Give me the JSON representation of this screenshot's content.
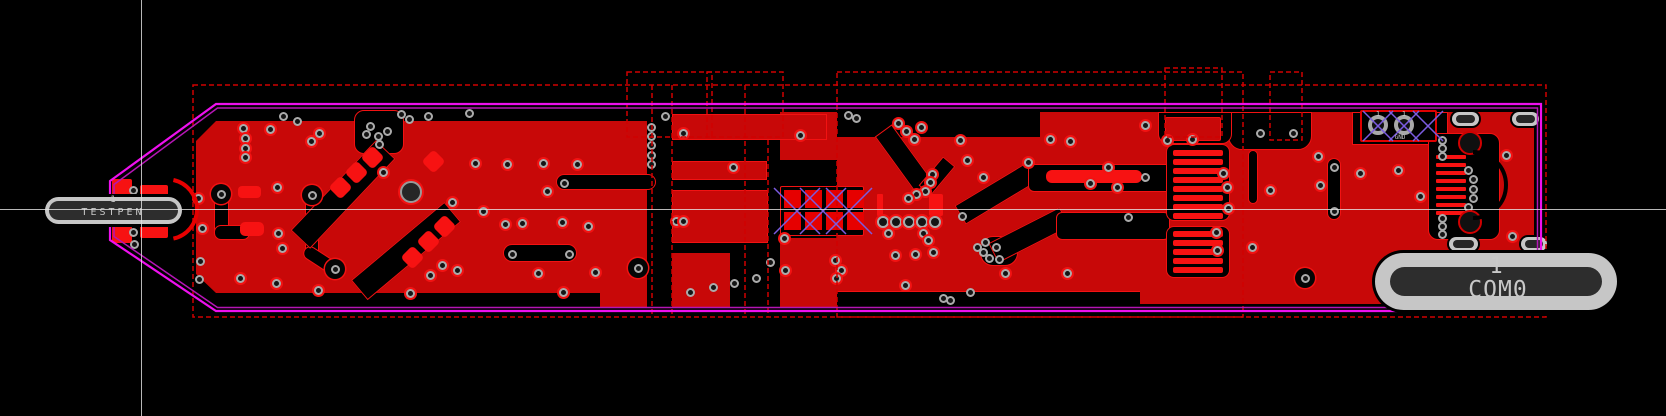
{
  "app": {
    "view": "pcb-copper-layer-viewer"
  },
  "labels": {
    "left_pad_number": "1",
    "left_pad_name": "TESTPEN",
    "right_pad_number": "1",
    "right_pad_name": "COM0",
    "th_pad1_label": "1",
    "th_pad2_label": "1",
    "th_pad2_sub": "GND"
  },
  "colors": {
    "background": "#000000",
    "copper_pour": "#C80808",
    "pad_bright": "#F71212",
    "clearance_edge": "#F21212",
    "hatch_pad": "#E60000",
    "courtyard_dash": "#CF0000",
    "outline_main": "#EE10EE",
    "outline_inner": "#B515B5",
    "hatch_x": "#7B5BE0",
    "via_ring": "#ABABAB",
    "via_hole": "#141414",
    "pill_body": "#C6C6C6",
    "pill_slot": "#2D2D2D",
    "crosshair": "#E5E5E5",
    "arc_red": "#E80000"
  },
  "crosshair": {
    "x": 141.5,
    "y": 209.5
  },
  "board": {
    "outline_outer": "110,181 216,104 1541,104 1541,311 216,311 110,240",
    "outline_inner": "114,184.5 217.5,108 1537.5,108 1537.5,307.5 217.5,307.5 114,236.5"
  },
  "pills": {
    "left": {
      "x": 45,
      "y": 197,
      "w": 137,
      "h": 27,
      "inset": 4,
      "num": {
        "x": 113,
        "y": 195,
        "fs": 9
      },
      "name": {
        "x": 113,
        "y": 207,
        "fs": 10,
        "ls": 3
      }
    },
    "right": {
      "x": 1375,
      "y": 253,
      "w": 242,
      "h": 57,
      "inset_x": 15,
      "inset_y": 14,
      "num": {
        "x": 1496,
        "y": 254,
        "fs": 22
      },
      "name": {
        "x": 1498,
        "y": 277,
        "fs": 23,
        "ls": 1
      }
    }
  },
  "gray_pills": [
    [
      1452,
      112,
      27,
      14
    ],
    [
      1512,
      112,
      27,
      14
    ],
    [
      1449,
      237,
      29,
      14
    ],
    [
      1521,
      237,
      26,
      14
    ]
  ],
  "zones": [
    {
      "x": 196,
      "y": 121,
      "w": 451,
      "h": 172,
      "clip": "polygon(0px 20px, 20px 0px, 100% 0px, 100% 100%, 20px 100%, 0px calc(100% - 19px))"
    },
    {
      "x": 837,
      "y": 137,
      "w": 203,
      "h": 156
    },
    {
      "x": 1040,
      "y": 112,
      "w": 494,
      "h": 192
    },
    {
      "x": 600,
      "y": 250,
      "w": 47,
      "h": 58
    },
    {
      "x": 672,
      "y": 253,
      "w": 58,
      "h": 55
    },
    {
      "x": 780,
      "y": 112,
      "w": 57,
      "h": 48
    },
    {
      "x": 780,
      "y": 238,
      "w": 57,
      "h": 70
    }
  ],
  "blacks": [
    {
      "x": 354,
      "y": 110,
      "w": 50,
      "h": 44,
      "r": "10px"
    },
    {
      "x": 556,
      "y": 174,
      "w": 100,
      "h": 16,
      "r": "8px"
    },
    {
      "x": 503,
      "y": 244,
      "w": 74,
      "h": 18,
      "r": "9px"
    },
    {
      "x": 214,
      "y": 189,
      "w": 15,
      "h": 47,
      "r": "7px"
    },
    {
      "x": 214,
      "y": 225,
      "w": 36,
      "h": 15,
      "r": "7px"
    },
    {
      "x": 305,
      "y": 190,
      "w": 14,
      "h": 66,
      "r": "7px"
    },
    {
      "cx": 322,
      "cy": 261,
      "w": 42,
      "h": 14,
      "rot": 33,
      "r": "7px"
    },
    {
      "cx": 343,
      "cy": 194,
      "w": 124,
      "h": 27,
      "rot": -46.5
    },
    {
      "cx": 406,
      "cy": 251,
      "w": 122,
      "h": 26,
      "rot": -40
    },
    {
      "cx": 905,
      "cy": 160,
      "w": 74,
      "h": 21,
      "rot": 54
    },
    {
      "cx": 937,
      "cy": 176,
      "w": 38,
      "h": 16,
      "rot": -50
    },
    {
      "cx": 997,
      "cy": 193,
      "w": 86,
      "h": 22,
      "rot": -31
    },
    {
      "x": 1028,
      "y": 164,
      "w": 144,
      "h": 28,
      "r": "6px"
    },
    {
      "x": 980,
      "y": 236,
      "w": 38,
      "h": 30,
      "r": "13px"
    },
    {
      "cx": 1029,
      "cy": 235,
      "w": 80,
      "h": 22,
      "rot": -27
    },
    {
      "x": 1056,
      "y": 212,
      "w": 114,
      "h": 28,
      "r": "6px"
    },
    {
      "x": 1327,
      "y": 158,
      "w": 14,
      "h": 62,
      "r": "7px"
    },
    {
      "x": 1248,
      "y": 150,
      "w": 10,
      "h": 54,
      "r": "5px"
    },
    {
      "x": 1352,
      "y": 112,
      "w": 96,
      "h": 33
    },
    {
      "x": 1228,
      "y": 112,
      "w": 84,
      "h": 38,
      "r": "0 0 14px 14px"
    },
    {
      "x": 1158,
      "y": 112,
      "w": 74,
      "h": 32,
      "r": "0 0 10px 10px"
    },
    {
      "x": 837,
      "y": 291,
      "w": 303,
      "h": 20,
      "bd": "top"
    },
    {
      "x": 1166,
      "y": 144,
      "w": 64,
      "h": 77,
      "r": "8px"
    },
    {
      "x": 1166,
      "y": 226,
      "w": 64,
      "h": 52,
      "r": "8px"
    },
    {
      "x": 1428,
      "y": 133,
      "w": 72,
      "h": 107,
      "r": "10px"
    },
    {
      "x": 780,
      "y": 186,
      "w": 84,
      "h": 50,
      "r": "2px"
    },
    {
      "x": 1360,
      "y": 110,
      "w": 77,
      "h": 32,
      "r": "2px",
      "bc": "#E00000",
      "bw": 2
    }
  ],
  "reds": [
    {
      "x": 238,
      "y": 186,
      "w": 23,
      "h": 12,
      "r": 4
    },
    {
      "x": 240,
      "y": 222,
      "w": 24,
      "h": 14,
      "r": 5
    },
    {
      "x": 112,
      "y": 179,
      "w": 20,
      "h": 17,
      "r": 2
    },
    {
      "x": 140,
      "y": 185,
      "w": 28,
      "h": 13,
      "r": 2
    },
    {
      "x": 112,
      "y": 226,
      "w": 20,
      "h": 17,
      "r": 2
    },
    {
      "x": 140,
      "y": 224,
      "w": 28,
      "h": 14,
      "r": 2
    },
    {
      "x": 877,
      "y": 194,
      "w": 6,
      "h": 22,
      "r": 1
    },
    {
      "x": 929,
      "y": 194,
      "w": 14,
      "h": 22,
      "r": 2
    },
    {
      "x": 1046,
      "y": 170,
      "w": 96,
      "h": 13,
      "r": 6
    },
    {
      "x": 1165,
      "y": 117,
      "w": 56,
      "h": 24,
      "r": 2,
      "c": "p"
    },
    {
      "x": 672,
      "y": 114,
      "w": 155,
      "h": 26,
      "c": "p"
    },
    {
      "x": 672,
      "y": 161,
      "w": 95,
      "h": 19,
      "c": "p"
    },
    {
      "x": 672,
      "y": 190,
      "w": 96,
      "h": 53,
      "c": "p"
    },
    {
      "x": 1173,
      "y": 150,
      "w": 50,
      "h": 6,
      "r": 2
    },
    {
      "x": 1173,
      "y": 159,
      "w": 50,
      "h": 6,
      "r": 2
    },
    {
      "x": 1173,
      "y": 168,
      "w": 50,
      "h": 6,
      "r": 2
    },
    {
      "x": 1173,
      "y": 177,
      "w": 50,
      "h": 6,
      "r": 2
    },
    {
      "x": 1173,
      "y": 186,
      "w": 50,
      "h": 6,
      "r": 2
    },
    {
      "x": 1173,
      "y": 195,
      "w": 50,
      "h": 6,
      "r": 2
    },
    {
      "x": 1173,
      "y": 204,
      "w": 50,
      "h": 6,
      "r": 2
    },
    {
      "x": 1173,
      "y": 213,
      "w": 50,
      "h": 6,
      "r": 2
    },
    {
      "x": 1173,
      "y": 231,
      "w": 50,
      "h": 6,
      "r": 2
    },
    {
      "x": 1173,
      "y": 240,
      "w": 50,
      "h": 6,
      "r": 2
    },
    {
      "x": 1173,
      "y": 249,
      "w": 50,
      "h": 6,
      "r": 2
    },
    {
      "x": 1173,
      "y": 258,
      "w": 50,
      "h": 6,
      "r": 2
    },
    {
      "x": 1173,
      "y": 267,
      "w": 50,
      "h": 6,
      "r": 2
    },
    {
      "x": 1436,
      "y": 155,
      "w": 30,
      "h": 4,
      "r": 1
    },
    {
      "x": 1436,
      "y": 163,
      "w": 30,
      "h": 4,
      "r": 1
    },
    {
      "x": 1436,
      "y": 171,
      "w": 30,
      "h": 4,
      "r": 1
    },
    {
      "x": 1436,
      "y": 179,
      "w": 30,
      "h": 4,
      "r": 1
    },
    {
      "x": 1436,
      "y": 187,
      "w": 30,
      "h": 4,
      "r": 1
    },
    {
      "x": 1436,
      "y": 195,
      "w": 30,
      "h": 4,
      "r": 1
    },
    {
      "x": 1436,
      "y": 203,
      "w": 30,
      "h": 4,
      "r": 1
    },
    {
      "x": 1436,
      "y": 211,
      "w": 30,
      "h": 4,
      "r": 1
    },
    {
      "x": 784,
      "y": 190,
      "w": 17,
      "h": 18,
      "c": "h"
    },
    {
      "x": 805,
      "y": 190,
      "w": 17,
      "h": 18,
      "c": "h"
    },
    {
      "x": 826,
      "y": 190,
      "w": 17,
      "h": 18,
      "c": "h"
    },
    {
      "x": 847,
      "y": 190,
      "w": 17,
      "h": 18,
      "c": "h"
    },
    {
      "x": 784,
      "y": 212,
      "w": 17,
      "h": 18,
      "c": "h"
    },
    {
      "x": 805,
      "y": 212,
      "w": 17,
      "h": 18,
      "c": "h"
    },
    {
      "x": 826,
      "y": 212,
      "w": 17,
      "h": 18,
      "c": "h"
    },
    {
      "x": 847,
      "y": 212,
      "w": 17,
      "h": 18,
      "c": "h"
    }
  ],
  "diamonds": [
    [
      340,
      187
    ],
    [
      356,
      172
    ],
    [
      372,
      157
    ],
    [
      433,
      161
    ],
    [
      412,
      257
    ],
    [
      428,
      241
    ],
    [
      444,
      226
    ]
  ],
  "diamond_size": 17,
  "vias": [
    [
      133,
      190,
      1
    ],
    [
      133,
      232,
      1
    ],
    [
      134,
      244,
      1
    ],
    [
      198,
      198,
      0
    ],
    [
      202,
      228,
      0
    ],
    [
      200,
      261,
      1
    ],
    [
      199,
      279,
      1
    ],
    [
      221,
      194,
      2
    ],
    [
      312,
      195,
      2
    ],
    [
      335,
      269,
      2
    ],
    [
      638,
      268,
      2
    ],
    [
      1305,
      278,
      2
    ],
    [
      240,
      278,
      0
    ],
    [
      276,
      283,
      0
    ],
    [
      318,
      290,
      0
    ],
    [
      410,
      293,
      0
    ],
    [
      457,
      270,
      0
    ],
    [
      538,
      273,
      0
    ],
    [
      595,
      272,
      0
    ],
    [
      563,
      292,
      0
    ],
    [
      277,
      187,
      0
    ],
    [
      278,
      233,
      0
    ],
    [
      282,
      248,
      0
    ],
    [
      243,
      128,
      0
    ],
    [
      245,
      138,
      0
    ],
    [
      245,
      148,
      0
    ],
    [
      245,
      157,
      0
    ],
    [
      270,
      129,
      0
    ],
    [
      283,
      116,
      1
    ],
    [
      297,
      121,
      1
    ],
    [
      311,
      141,
      0
    ],
    [
      319,
      133,
      0
    ],
    [
      401,
      114,
      1
    ],
    [
      409,
      119,
      1
    ],
    [
      428,
      116,
      1
    ],
    [
      469,
      113,
      1
    ],
    [
      370,
      126,
      1
    ],
    [
      366,
      134,
      1
    ],
    [
      378,
      136,
      1
    ],
    [
      387,
      131,
      1
    ],
    [
      379,
      144,
      1
    ],
    [
      383,
      172,
      0
    ],
    [
      475,
      163,
      0
    ],
    [
      507,
      164,
      0
    ],
    [
      543,
      163,
      0
    ],
    [
      577,
      164,
      0
    ],
    [
      547,
      191,
      0
    ],
    [
      483,
      211,
      0
    ],
    [
      452,
      202,
      0
    ],
    [
      505,
      224,
      0
    ],
    [
      522,
      223,
      0
    ],
    [
      562,
      222,
      0
    ],
    [
      588,
      226,
      0
    ],
    [
      512,
      254,
      1
    ],
    [
      569,
      254,
      1
    ],
    [
      564,
      183,
      1
    ],
    [
      442,
      265,
      0
    ],
    [
      430,
      275,
      0
    ],
    [
      651,
      127,
      1
    ],
    [
      651,
      136,
      1
    ],
    [
      651,
      145,
      1
    ],
    [
      651,
      155,
      1
    ],
    [
      651,
      164,
      1
    ],
    [
      665,
      116,
      1
    ],
    [
      683,
      133,
      0
    ],
    [
      800,
      135,
      0
    ],
    [
      733,
      167,
      0
    ],
    [
      676,
      221,
      0
    ],
    [
      683,
      221,
      0
    ],
    [
      690,
      292,
      1
    ],
    [
      713,
      287,
      1
    ],
    [
      734,
      283,
      1
    ],
    [
      756,
      278,
      1
    ],
    [
      770,
      262,
      1
    ],
    [
      784,
      238,
      0
    ],
    [
      785,
      270,
      0
    ],
    [
      835,
      260,
      0
    ],
    [
      841,
      270,
      0
    ],
    [
      836,
      278,
      0
    ],
    [
      848,
      115,
      1
    ],
    [
      856,
      118,
      1
    ],
    [
      898,
      123,
      0
    ],
    [
      906,
      131,
      0
    ],
    [
      914,
      139,
      0
    ],
    [
      921,
      127,
      0
    ],
    [
      960,
      140,
      0
    ],
    [
      967,
      160,
      0
    ],
    [
      1028,
      162,
      0
    ],
    [
      983,
      177,
      0
    ],
    [
      1090,
      183,
      0
    ],
    [
      932,
      174,
      0
    ],
    [
      930,
      182,
      0
    ],
    [
      925,
      191,
      0
    ],
    [
      916,
      194,
      0
    ],
    [
      908,
      198,
      0
    ],
    [
      883,
      222,
      3
    ],
    [
      896,
      222,
      3
    ],
    [
      909,
      222,
      3
    ],
    [
      922,
      222,
      3
    ],
    [
      935,
      222,
      3
    ],
    [
      888,
      233,
      0
    ],
    [
      923,
      233,
      0
    ],
    [
      928,
      240,
      0
    ],
    [
      933,
      252,
      0
    ],
    [
      895,
      255,
      0
    ],
    [
      915,
      254,
      0
    ],
    [
      962,
      216,
      1
    ],
    [
      977,
      247,
      1
    ],
    [
      983,
      252,
      1
    ],
    [
      989,
      258,
      1
    ],
    [
      985,
      242,
      1
    ],
    [
      996,
      247,
      1
    ],
    [
      999,
      259,
      1
    ],
    [
      1005,
      273,
      0
    ],
    [
      970,
      292,
      1
    ],
    [
      943,
      298,
      1
    ],
    [
      950,
      300,
      1
    ],
    [
      905,
      285,
      0
    ],
    [
      1067,
      273,
      0
    ],
    [
      1050,
      139,
      0
    ],
    [
      1070,
      141,
      0
    ],
    [
      1108,
      167,
      0
    ],
    [
      1117,
      187,
      0
    ],
    [
      1128,
      217,
      1
    ],
    [
      1145,
      177,
      1
    ],
    [
      1145,
      125,
      0
    ],
    [
      1167,
      140,
      0
    ],
    [
      1192,
      139,
      0
    ],
    [
      1223,
      173,
      0
    ],
    [
      1227,
      187,
      0
    ],
    [
      1228,
      208,
      0
    ],
    [
      1216,
      232,
      0
    ],
    [
      1217,
      250,
      0
    ],
    [
      1260,
      133,
      1
    ],
    [
      1293,
      133,
      1
    ],
    [
      1318,
      156,
      0
    ],
    [
      1360,
      173,
      0
    ],
    [
      1320,
      185,
      0
    ],
    [
      1270,
      190,
      0
    ],
    [
      1252,
      247,
      0
    ],
    [
      1334,
      167,
      1
    ],
    [
      1334,
      211,
      1
    ],
    [
      1398,
      170,
      0
    ],
    [
      1420,
      196,
      0
    ],
    [
      1506,
      155,
      0
    ],
    [
      1512,
      236,
      0
    ],
    [
      1442,
      140,
      1
    ],
    [
      1442,
      148,
      1
    ],
    [
      1442,
      156,
      1
    ],
    [
      1442,
      218,
      1
    ],
    [
      1442,
      226,
      1
    ],
    [
      1442,
      234,
      1
    ],
    [
      1468,
      170,
      1
    ],
    [
      1473,
      179,
      1
    ],
    [
      1473,
      189,
      1
    ],
    [
      1473,
      198,
      1
    ],
    [
      1468,
      207,
      1
    ]
  ],
  "holes": [
    {
      "x": 411,
      "y": 192,
      "r": 11,
      "ring": "#999999",
      "rw": 2,
      "fill": "#262626",
      "clear": true
    },
    {
      "x": 1378,
      "y": 125,
      "r": 10,
      "ring": "#A8A8A8",
      "rw": 4,
      "fill": "#101010"
    },
    {
      "x": 1404,
      "y": 125,
      "r": 10,
      "ring": "#A8A8A8",
      "rw": 4,
      "fill": "#101010"
    },
    {
      "x": 1470,
      "y": 143,
      "r": 12,
      "ring": "#D00000",
      "rw": 2.5,
      "fill": "#101010"
    },
    {
      "x": 1470,
      "y": 222,
      "r": 12,
      "ring": "#D00000",
      "rw": 2.5,
      "fill": "#101010"
    },
    {
      "x": 177,
      "y": 209,
      "r": 4,
      "ring": "#EDEDED",
      "rw": 1.5,
      "fill": "#333333"
    }
  ],
  "courtyard_rects": [
    [
      193,
      85,
      1353,
      232
    ],
    [
      627,
      72,
      85,
      65
    ],
    [
      707,
      72,
      76,
      65
    ],
    [
      837,
      72,
      406,
      245
    ],
    [
      1165,
      68,
      57,
      69
    ],
    [
      1270,
      72,
      32,
      68
    ]
  ],
  "courtyard_lines": [
    [
      652,
      85,
      652,
      317
    ],
    [
      672,
      85,
      672,
      317
    ],
    [
      745,
      85,
      745,
      317
    ],
    [
      768,
      140,
      768,
      317
    ]
  ],
  "arcs": [
    {
      "d": "M 173.4 180 A 30 30 0 0 1 173.4 238.6",
      "c": "#E80000",
      "w": 4
    },
    {
      "d": "M 1473 152 A 33 33 0 0 1 1473 218",
      "c": "#000000",
      "w": 4
    }
  ],
  "x_marks": [
    {
      "cx": 1378,
      "cy": 126,
      "h": 15
    },
    {
      "cx": 1404,
      "cy": 126,
      "h": 15
    },
    {
      "cx": 1428,
      "cy": 126,
      "h": 15
    },
    {
      "cx": 797,
      "cy": 211,
      "h": 23
    },
    {
      "cx": 823,
      "cy": 211,
      "h": 23
    },
    {
      "cx": 849,
      "cy": 211,
      "h": 23
    }
  ],
  "texts": [
    {
      "x": 1378,
      "y": 110,
      "key": "th_pad1_label",
      "fs": 7
    },
    {
      "x": 1404,
      "y": 110,
      "key": "th_pad2_label",
      "fs": 7
    },
    {
      "x": 1400,
      "y": 134,
      "key": "th_pad2_sub",
      "fs": 6
    }
  ]
}
